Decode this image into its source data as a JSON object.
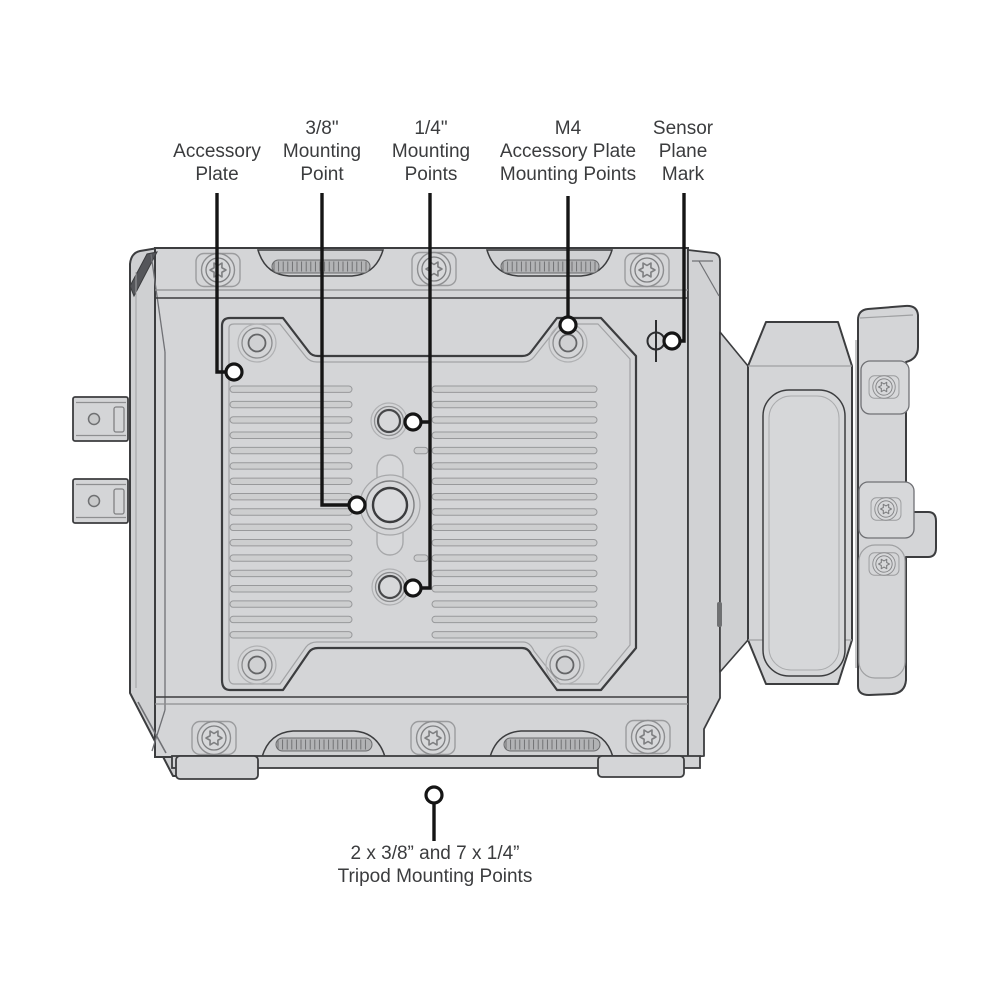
{
  "figure": {
    "type": "technical-line-diagram",
    "subject": "camera underside mounting points",
    "background_color": "#ffffff",
    "body_fill": "#d4d5d7",
    "outline_color": "#3c3d3f",
    "leader_color": "#151515",
    "text_color": "#3b3c3e"
  },
  "labels": {
    "accessory_plate": {
      "lines": [
        "Accessory",
        "Plate"
      ]
    },
    "mounting_3_8": {
      "lines": [
        "3/8\"",
        "Mounting",
        "Point"
      ]
    },
    "mounting_1_4": {
      "lines": [
        "1/4\"",
        "Mounting",
        "Points"
      ]
    },
    "m4_accessory": {
      "lines": [
        "M4",
        "Accessory Plate",
        "Mounting Points"
      ]
    },
    "sensor_plane": {
      "lines": [
        "Sensor",
        "Plane",
        "Mark"
      ]
    },
    "tripod": {
      "lines": [
        "2 x 3/8” and 7 x 1/4”",
        "Tripod Mounting Points"
      ]
    }
  },
  "symbols": {
    "sensor_plane_mark": "φ"
  }
}
